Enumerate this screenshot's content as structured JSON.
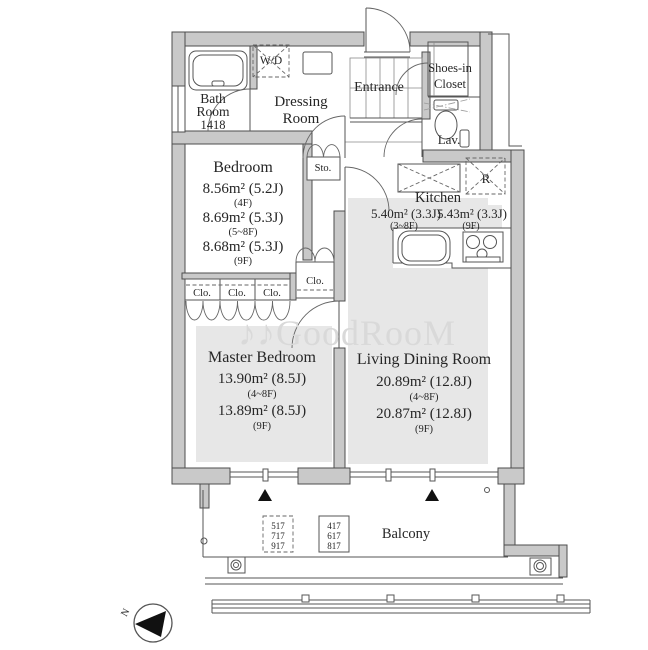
{
  "watermark": {
    "text": "♪♪GoodRooM"
  },
  "compass": {
    "label": "N"
  },
  "rooms": {
    "bath": {
      "l1": "Bath",
      "l2": "Room",
      "l3": "1418"
    },
    "wd": {
      "label": "W/D"
    },
    "dressing": {
      "l1": "Dressing",
      "l2": "Room"
    },
    "entrance": {
      "label": "Entrance"
    },
    "shoes_closet": {
      "l1": "Shoes-in",
      "l2": "Closet"
    },
    "lavatory": {
      "label": "Lav."
    },
    "storage": {
      "label": "Sto."
    },
    "refrigerator": {
      "label": "R"
    },
    "bedroom": {
      "name": "Bedroom",
      "area1": "8.56m² (5.2J)",
      "floor1": "(4F)",
      "area2": "8.69m² (5.3J)",
      "floor2": "(5~8F)",
      "area3": "8.68m² (5.3J)",
      "floor3": "(9F)"
    },
    "kitchen": {
      "name": "Kitchen",
      "area1": "5.40m² (3.3J)",
      "floor1": "(3~8F)",
      "area2": "5.43m² (3.3J)",
      "floor2": "(9F)"
    },
    "closets": {
      "c1": "Clo.",
      "c2": "Clo.",
      "c3": "Clo.",
      "c4": "Clo."
    },
    "master_bedroom": {
      "name": "Master Bedroom",
      "area1": "13.90m² (8.5J)",
      "floor1": "(4~8F)",
      "area2": "13.89m² (8.5J)",
      "floor2": "(9F)"
    },
    "living": {
      "name": "Living Dining Room",
      "area1": "20.89m² (12.8J)",
      "floor1": "(4~8F)",
      "area2": "20.87m² (12.8J)",
      "floor2": "(9F)"
    },
    "balcony": {
      "name": "Balcony",
      "units_dashed": [
        "517",
        "717",
        "917"
      ],
      "units_solid": [
        "417",
        "617",
        "817"
      ]
    }
  },
  "colors": {
    "wall_fill": "#c9c9c9",
    "wall_stroke": "#4d4d4d",
    "room_shade": "#e7e7e7",
    "text": "#262626",
    "watermark": "#d9d9d9",
    "triangle": "#111111"
  }
}
